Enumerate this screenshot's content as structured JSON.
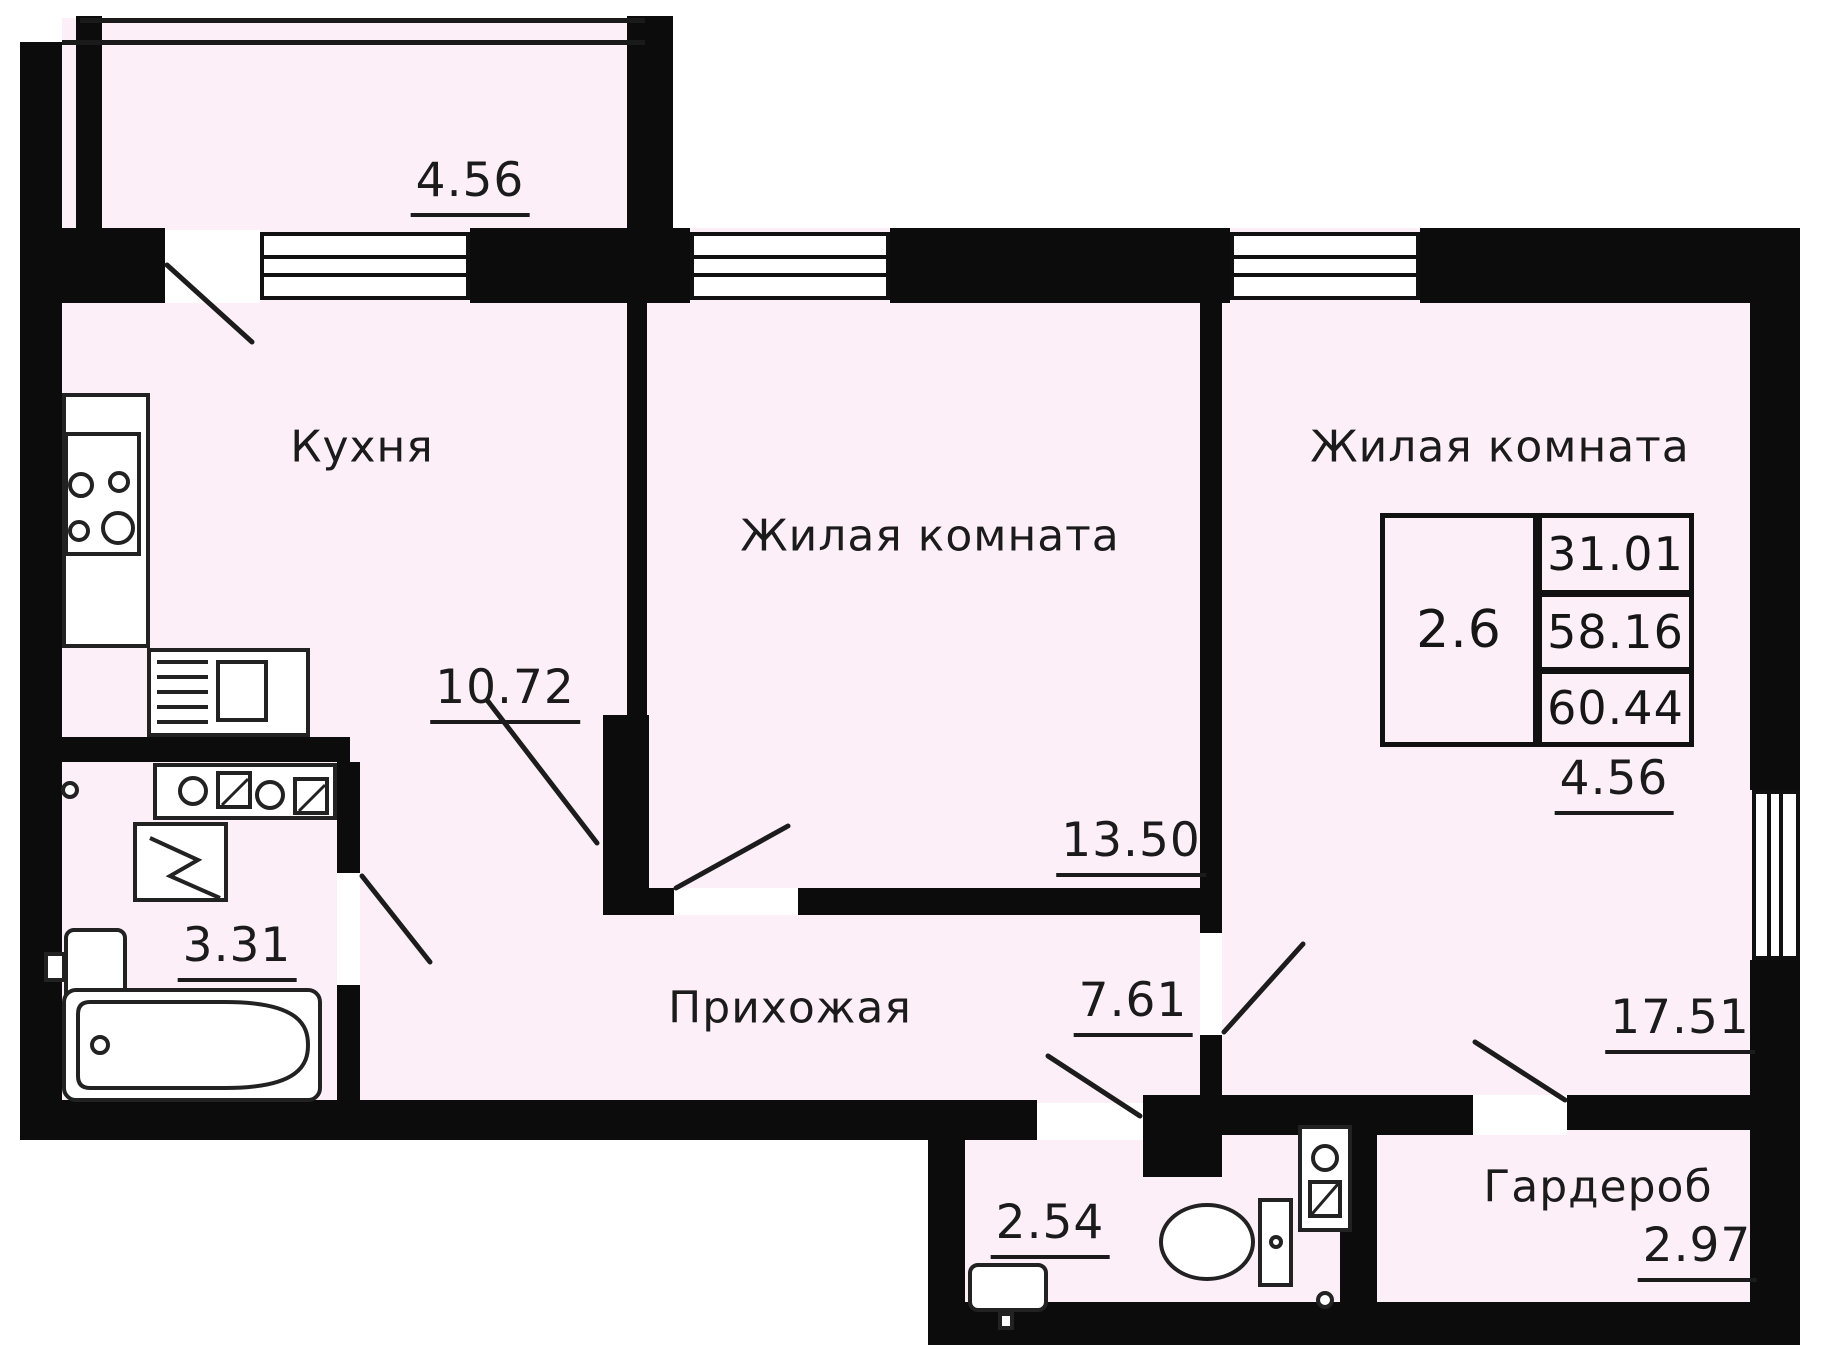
{
  "plan": {
    "rooms": {
      "kitchen": {
        "label": "Кухня",
        "area": "10.72"
      },
      "living_middle": {
        "label": "Жилая комната",
        "area": "13.50"
      },
      "living_right": {
        "label": "Жилая комната",
        "area": "17.51"
      },
      "hallway": {
        "label": "Прихожая",
        "area": "7.61"
      },
      "bathroom": {
        "area": "3.31"
      },
      "wc": {
        "area": "2.54"
      },
      "wardrobe": {
        "label": "Гардероб",
        "area": "2.97"
      },
      "balcony": {
        "area": "4.56"
      },
      "loggia_right": {
        "area": "4.56"
      }
    },
    "info_table": {
      "unit": "2.6",
      "living_area": "31.01",
      "apartment_area": "58.16",
      "total_area": "60.44"
    },
    "colors": {
      "interior": "#fceff8",
      "wall": "#0c0c0c",
      "line": "#1c1c1c"
    }
  }
}
